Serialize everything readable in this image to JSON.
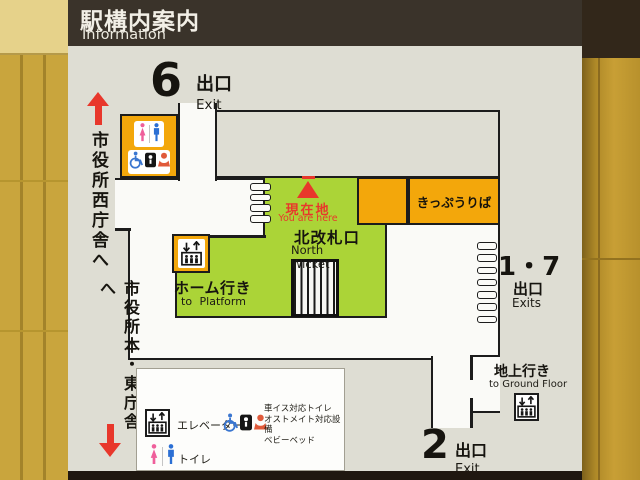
{
  "header": {
    "title_jp": "駅構内案内",
    "title_en": "Information"
  },
  "exit6": {
    "num": "6",
    "suffix_jp": "出口",
    "suffix_en": "Exit"
  },
  "exit17": {
    "num": "1・7",
    "suffix_jp": "出口",
    "suffix_en": "Exits"
  },
  "exit2": {
    "num": "2",
    "suffix_jp": "出口",
    "suffix_en": "Exit"
  },
  "side_labels": {
    "to_west_hall": "市役所西庁舎へ",
    "to_main_east_hall": "市役所本・東庁舎へ"
  },
  "map_labels": {
    "you_are_here_jp": "現在地",
    "you_are_here_en": "You are here",
    "north_wicket_jp": "北改札口",
    "north_wicket_en": "North Wicket",
    "to_platform_jp": "ホーム行き",
    "to_platform_en": "to Platform",
    "ticket_office": "きっぷうりば",
    "to_ground_jp": "地上行き",
    "to_ground_en": "to Ground Floor"
  },
  "legend": {
    "elevator": "エレベーター",
    "toilet": "トイレ",
    "accessible_l1": "車イス対応トイレ",
    "accessible_l2": "オストメイト対応設備",
    "accessible_l3": "ベビーベッド"
  },
  "colors": {
    "header_brown": "#3a332a",
    "sign_gray": "#deddd3",
    "accent_orange": "#f3a70b",
    "walkway_green": "#abd437",
    "marker_red": "#e8372b",
    "female_pink": "#ef5f9b",
    "male_blue": "#2b6fd4",
    "wall_black": "#1c1c1c"
  }
}
